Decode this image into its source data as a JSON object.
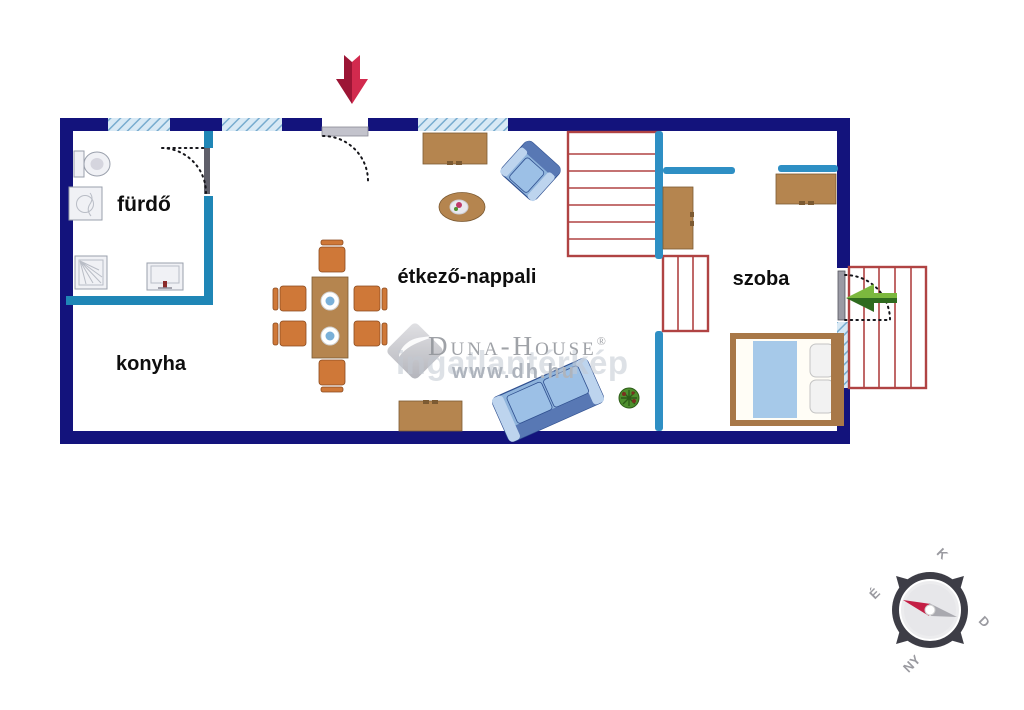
{
  "rooms": {
    "bathroom": "fürdő",
    "kitchen": "konyha",
    "living_dining": "étkező-nappali",
    "bedroom": "szoba"
  },
  "watermark": {
    "brand": "Duna-House",
    "registered": "®",
    "url": "www.dh.hu",
    "echo": "ingatlantérkép"
  },
  "compass": {
    "north_label": "É",
    "east_label": "K",
    "south_label": "D",
    "west_label": "NY"
  },
  "icons": {
    "main_entrance_arrow": "red-down-arrow",
    "terrace_entrance_arrow": "green-left-arrow",
    "compass_rose": "compass"
  },
  "colors": {
    "wall": "#13137c",
    "partition": "#2e8fc4",
    "bathroom_wall": "#1f86b6",
    "stair": "#b04343",
    "window_fill": "#d8e9f5",
    "window_stripe": "#78accf",
    "wood": "#b5854f",
    "wood_dark": "#7c5a32",
    "chair": "#cf7838",
    "chair_dark": "#8a4a1e",
    "sofa": "#8fb4dc",
    "sofa_dark": "#5878b4",
    "sofa_edge": "#2f4f8f",
    "blanket": "#a6c9e9",
    "bed_frame": "#a87848",
    "plant": "#4e8f2e",
    "arrow_red": "#d22a4e",
    "arrow_red_dark": "#9c1535",
    "arrow_green": "#7cb83e",
    "arrow_green_dark": "#2f6b1f",
    "label": "#0e0e0e",
    "watermark": "#8f9298",
    "compass_body": "#3d3d46",
    "leaf": "#5f5f6a"
  }
}
